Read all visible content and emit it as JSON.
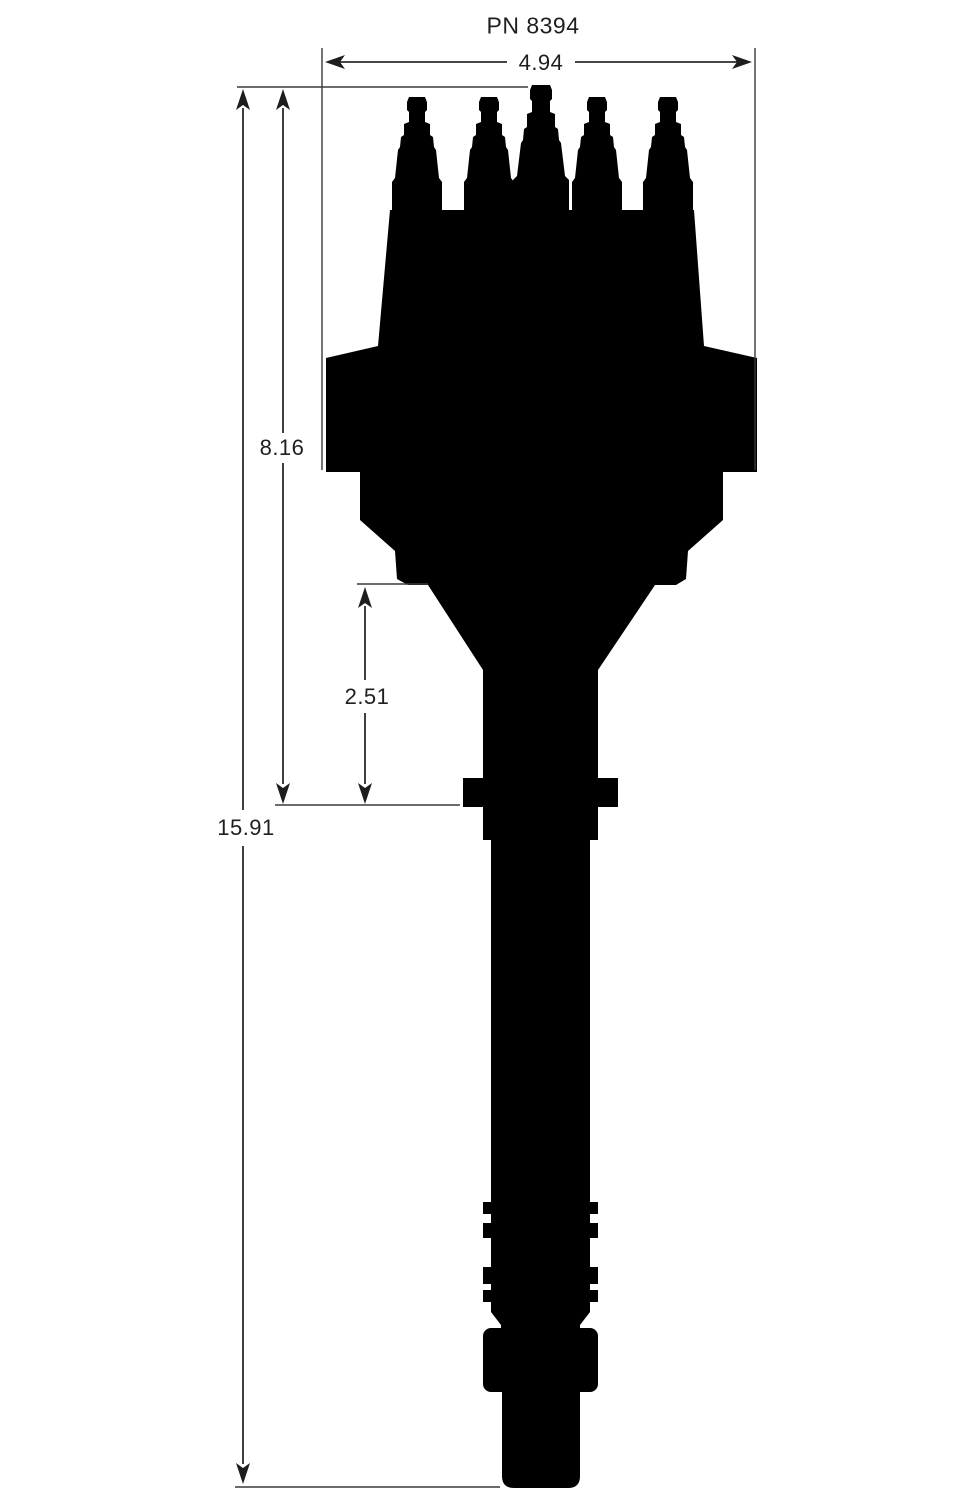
{
  "title": "PN 8394",
  "dimensions": {
    "cap_width": "4.94",
    "upper_height": "8.16",
    "lower_section": "2.51",
    "overall_height": "15.91"
  },
  "colors": {
    "silhouette": "#000000",
    "dimension_lines": "#2b2b2b",
    "text": "#1f1f1f",
    "background": "#ffffff"
  }
}
